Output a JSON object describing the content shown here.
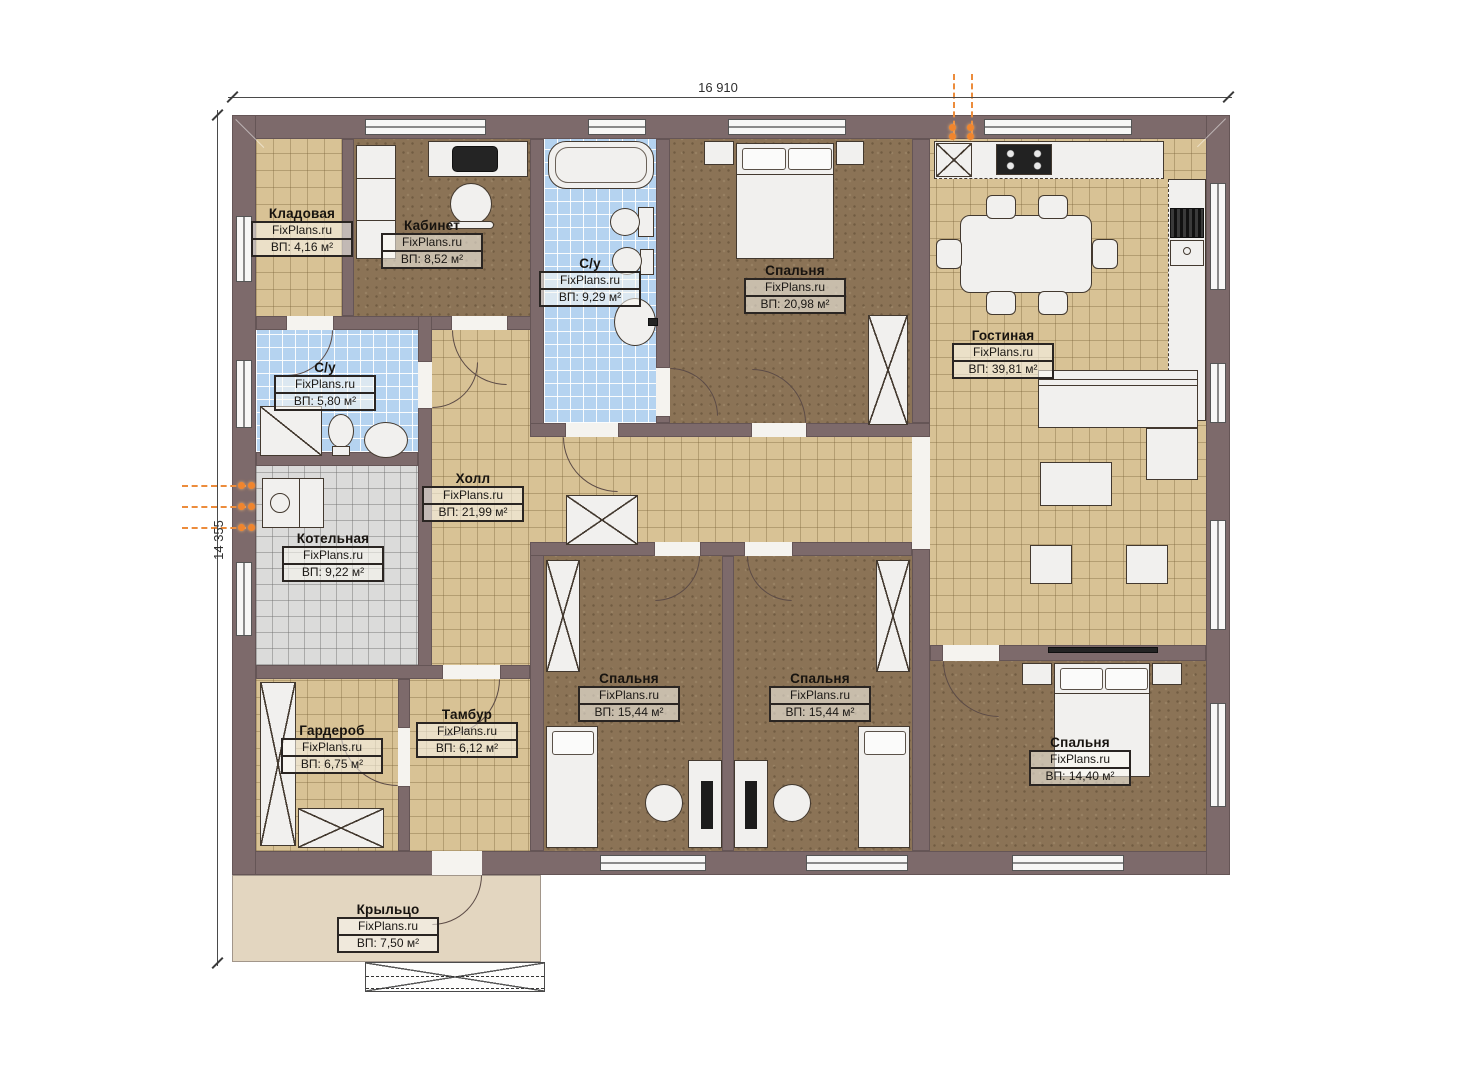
{
  "plan_title": "Floor plan",
  "brand_watermark": "FixPlans.ru",
  "dimensions": {
    "width_label": "16 910",
    "height_label": "14 355"
  },
  "rooms": [
    {
      "name": "Кладовая",
      "brand": "FixPlans.ru",
      "area": "ВП: 4,16 м²"
    },
    {
      "name": "Кабинет",
      "brand": "FixPlans.ru",
      "area": "ВП: 8,52 м²"
    },
    {
      "name": "С/у",
      "brand": "FixPlans.ru",
      "area": "ВП: 9,29 м²"
    },
    {
      "name": "Спальня",
      "brand": "FixPlans.ru",
      "area": "ВП: 20,98 м²"
    },
    {
      "name": "Гостиная",
      "brand": "FixPlans.ru",
      "area": "ВП: 39,81 м²"
    },
    {
      "name": "С/у",
      "brand": "FixPlans.ru",
      "area": "ВП: 5,80 м²"
    },
    {
      "name": "Холл",
      "brand": "FixPlans.ru",
      "area": "ВП: 21,99 м²"
    },
    {
      "name": "Котельная",
      "brand": "FixPlans.ru",
      "area": "ВП: 9,22 м²"
    },
    {
      "name": "Гардероб",
      "brand": "FixPlans.ru",
      "area": "ВП: 6,75 м²"
    },
    {
      "name": "Тамбур",
      "brand": "FixPlans.ru",
      "area": "ВП: 6,12 м²"
    },
    {
      "name": "Спальня",
      "brand": "FixPlans.ru",
      "area": "ВП: 15,44 м²"
    },
    {
      "name": "Спальня",
      "brand": "FixPlans.ru",
      "area": "ВП: 15,44 м²"
    },
    {
      "name": "Спальня",
      "brand": "FixPlans.ru",
      "area": "ВП: 14,40 м²"
    },
    {
      "name": "Крыльцо",
      "brand": "FixPlans.ru",
      "area": "ВП: 7,50 м²"
    }
  ],
  "colors": {
    "wall": "#7d6a6b",
    "tile_tan": "#d8c295",
    "tile_blue": "#b5d3f0",
    "tile_gray": "#dbdbda",
    "carpet_brown": "#8b7356",
    "porch": "#e3d6c0",
    "utility_orange": "#ec8c3c"
  }
}
